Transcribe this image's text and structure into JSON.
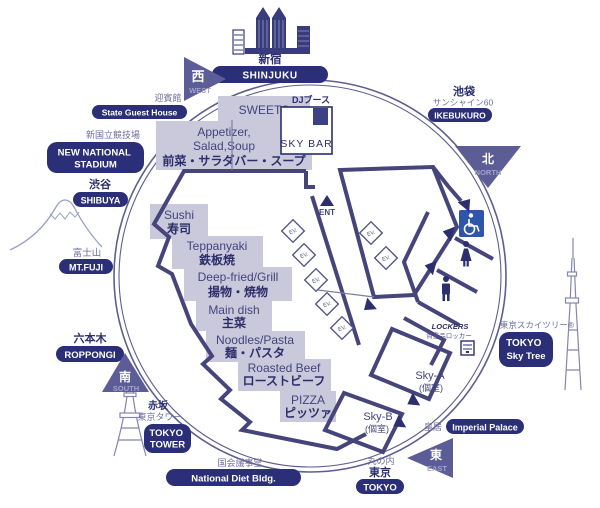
{
  "map": {
    "compass": {
      "west": {
        "kanji": "西",
        "label": "WEST"
      },
      "north": {
        "kanji": "北",
        "label": "NORTH"
      },
      "south": {
        "kanji": "南",
        "label": "SOUTH"
      },
      "east": {
        "kanji": "東",
        "label": "EAST"
      }
    },
    "landmarks": {
      "shinjuku": {
        "jp": "新宿",
        "badge": "SHINJUKU"
      },
      "state_guest_house": {
        "jp": "迎賓館",
        "badge": "State Guest House"
      },
      "new_national_stadium": {
        "jp": "新国立競技場",
        "line1": "NEW NATIONAL",
        "line2": "STADIUM"
      },
      "shibuya": {
        "jp": "渋谷",
        "badge": "SHIBUYA"
      },
      "mt_fuji": {
        "jp": "富士山",
        "badge": "MT.FUJI"
      },
      "roppongi": {
        "jp": "六本木",
        "badge": "ROPPONGI"
      },
      "tokyo_tower": {
        "jp": "赤坂",
        "jp2": "東京タワー",
        "line1": "TOKYO",
        "line2": "TOWER"
      },
      "national_diet": {
        "jp": "国会議事堂",
        "badge": "National Diet Bldg."
      },
      "tokyo_station": {
        "jp": "丸の内",
        "jp2": "東京",
        "badge": "TOKYO"
      },
      "imperial_palace": {
        "jp": "皇居",
        "badge": "Imperial Palace"
      },
      "sky_tree": {
        "jp": "東京スカイツリー®",
        "line1": "TOKYO",
        "line2": "Sky Tree"
      },
      "ikebukuro": {
        "jp": "池袋",
        "jp2": "サンシャイン60",
        "badge": "IKEBUKURO"
      }
    },
    "stations": {
      "sweets": {
        "en": "SWEETS",
        "jp": "スイーツ"
      },
      "appetizer": {
        "en1": "Appetizer,",
        "en2": "Salad,Soup",
        "jp": "前菜・サラダバー・スープ"
      },
      "sushi": {
        "en": "Sushi",
        "jp": "寿司"
      },
      "teppanyaki": {
        "en": "Teppanyaki",
        "jp": "鉄板焼"
      },
      "deep_fried": {
        "en": "Deep-fried/Grill",
        "jp": "揚物・焼物"
      },
      "main_dish": {
        "en": "Main dish",
        "jp": "主菜"
      },
      "noodles": {
        "en": "Noodles/Pasta",
        "jp": "麺・パスタ"
      },
      "roasted_beef": {
        "en": "Roasted Beef",
        "jp": "ローストビーフ"
      },
      "pizza": {
        "en": "PIZZA",
        "jp": "ピッツァ"
      }
    },
    "facilities": {
      "sky_bar": "SKY BAR",
      "dj_booth": "DJブース",
      "entrance": "ENT",
      "elevator": "EV.",
      "lockers_en": "LOCKERS",
      "lockers_jp": "貴重品ロッカー",
      "sky_a": "Sky-A",
      "sky_a_room": "(個室)",
      "sky_b": "Sky-B",
      "sky_b_room": "(個室)"
    },
    "icons": {
      "shinjuku_buildings": "skyscrapers",
      "mt_fuji": "mountain-outline",
      "tokyo_tower": "lattice-tower",
      "sky_tree": "broadcast-tower",
      "dj_booth": "filled-square",
      "entrance": "triangle-marker",
      "accessible": "wheelchair",
      "restroom_woman": "woman-pictogram",
      "restroom_man": "man-pictogram",
      "locker": "locker-cabinet"
    },
    "colors": {
      "navy": "#2b2f78",
      "compass_purple": "#5c5c97",
      "station_box": "#c9c9db",
      "wall": "#45457b",
      "ring": "#5e5e91",
      "accessible_blue": "#2e55a8"
    }
  }
}
